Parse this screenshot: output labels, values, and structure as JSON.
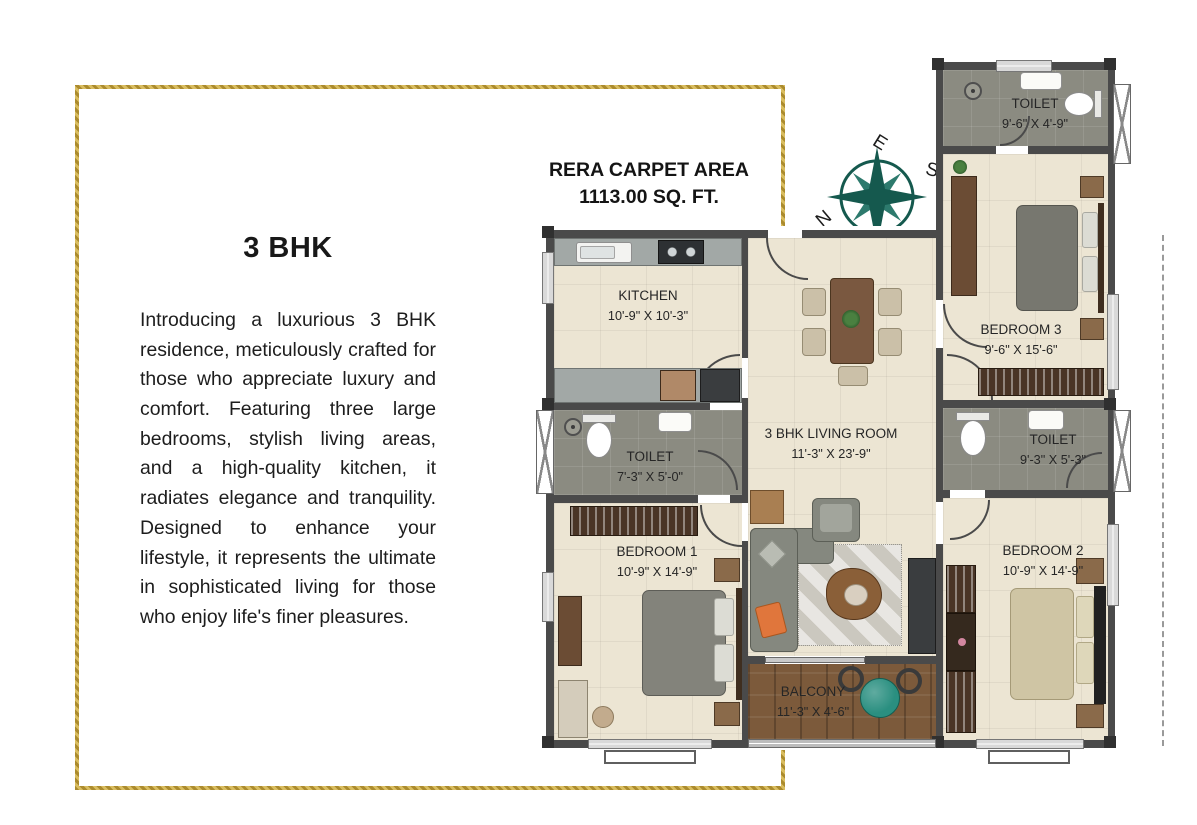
{
  "brochure": {
    "title": "3 BHK",
    "description": "Introducing a luxurious 3 BHK residence, meticulously crafted for those who appreciate luxury and comfort. Featuring three large bedrooms, stylish living areas, and a high-quality kitchen, it radiates elegance and tranquility. Designed to enhance your lifestyle, it represents the ultimate in sophisticated living for those who enjoy life's finer pleasures.",
    "border_color": "#c5a13d"
  },
  "carpet_area": {
    "line1": "RERA CARPET AREA",
    "line2": "1113.00 SQ. FT."
  },
  "compass": {
    "color": "#15594e",
    "top": "E",
    "right": "S",
    "bottom": "W",
    "left": "N"
  },
  "floorplan": {
    "rooms": [
      {
        "id": "kitchen",
        "name": "KITCHEN",
        "dims": "10'-9\" X 10'-3\""
      },
      {
        "id": "toilet-a",
        "name": "TOILET",
        "dims": "7'-3\" X 5'-0\""
      },
      {
        "id": "bedroom-1",
        "name": "BEDROOM 1",
        "dims": "10'-9\" X 14'-9\""
      },
      {
        "id": "living",
        "name": "3 BHK LIVING ROOM",
        "dims": "11'-3\" X 23'-9\""
      },
      {
        "id": "balcony",
        "name": "BALCONY",
        "dims": "11'-3\" X 4'-6\""
      },
      {
        "id": "toilet-b",
        "name": "TOILET",
        "dims": "9'-6\" X 4'-9\""
      },
      {
        "id": "bedroom-3",
        "name": "BEDROOM 3",
        "dims": "9'-6\" X 15'-6\""
      },
      {
        "id": "toilet-c",
        "name": "TOILET",
        "dims": "9'-3\" X 5'-3\""
      },
      {
        "id": "bedroom-2",
        "name": "BEDROOM 2",
        "dims": "10'-9\" X 14'-9\""
      }
    ],
    "colors": {
      "wall": "#4a4a4a",
      "floor_cream": "#ece5d3",
      "floor_tile": "#8b8b81",
      "floor_wood": "#7c5a3b",
      "sofa_pillow_accent": "#e0763c",
      "balcony_table": "#2a8f80"
    }
  }
}
